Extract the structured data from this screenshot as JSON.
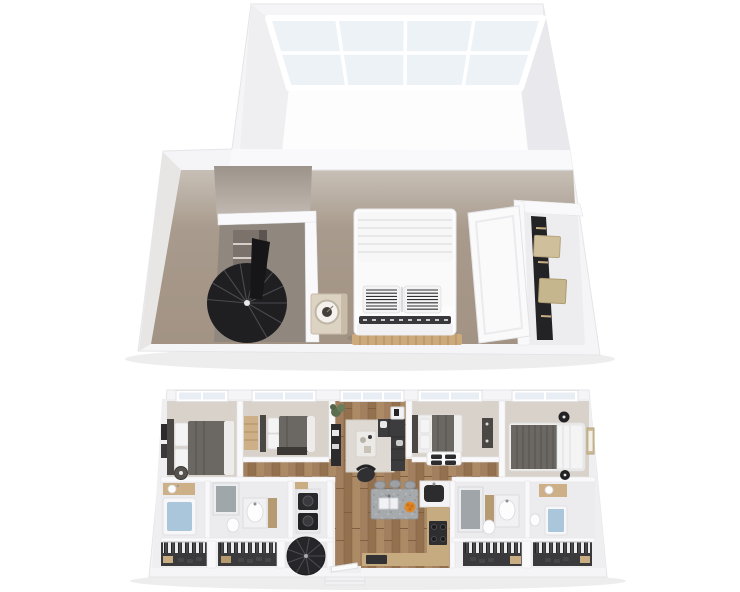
{
  "scene": {
    "type": "3d-floorplan-rendering",
    "levels": [
      {
        "name": "loft-level",
        "elements": [
          "skylight-windows",
          "loft-bedroom",
          "quilted-bed",
          "striped-accent-pillows",
          "nightstand-with-clock",
          "wood-slat-bench",
          "spiral-staircase",
          "closet-shelving",
          "wardrobe-sliding-door",
          "storage-boxes"
        ]
      },
      {
        "name": "main-level",
        "elements": [
          "bedroom-1",
          "bedroom-2",
          "bedroom-3",
          "bedroom-4",
          "living-room",
          "sectional-sofa",
          "coffee-table",
          "tv-console",
          "area-rug",
          "accent-chair",
          "potted-plant",
          "side-table",
          "kitchen-island",
          "bar-stools",
          "fruit-bowl",
          "range-stove",
          "kitchen-counters",
          "bathroom-1",
          "bathroom-2",
          "bathroom-3",
          "bathroom-4",
          "bathtub",
          "shower-stalls",
          "vanity-sinks",
          "toilets",
          "laundry-appliances",
          "closet-1",
          "closet-2",
          "closet-3",
          "closet-4",
          "hanging-clothes",
          "shoes",
          "spiral-staircase",
          "entry-door",
          "windows"
        ]
      }
    ]
  },
  "colors": {
    "wall": "#f5f5f7",
    "wall_inner": "#f9f9fb",
    "wall_edge": "#e5e5e8",
    "wall_face_left": "#efeff2",
    "wall_face_right": "#e9e9ed",
    "glass": "#edf2f7",
    "glass_bright": "#fdfdfe",
    "window_glass": "#e8eef3",
    "loft_floor_light": "#c8c0b7",
    "loft_floor": "#a89a8c",
    "loft_floor_deep": "#a29384",
    "nook_floor": "#90887f",
    "gray_wall_top": "#9c938b",
    "gray_wall_bottom": "#c4bcb4",
    "wood_a": "#a2805f",
    "wood_b": "#93714f",
    "wood_c": "#ad8a66",
    "wood_seam": "#7e5f42",
    "carpet": "#d8d2ca",
    "bath_floor": "#ececee",
    "closet_floor": "#3a3a3d",
    "bed_dark": "#6b6762",
    "bed_stripe": "#5a5651",
    "headboard": "#4a4745",
    "white_fabric": "#f4f4f5",
    "mattress": "#efeeec",
    "pillow_stripe": "#303034",
    "sofa": "#3c3c3f",
    "sofa_line": "#2e2e31",
    "black_furniture": "#232326",
    "dark_gray": "#2c2c2f",
    "stair": "#1f1f22",
    "stair_small": "#26262a",
    "stair_tread": "#4a4a4f",
    "tan": "#c9ae84",
    "tan_light": "#cdb088",
    "tan_deep": "#b6996d",
    "counter_tan": "#c6ab80",
    "water_blue": "#a9c6db",
    "granite_base": "#a6aaad",
    "orange": "#e0882c",
    "orange_deep": "#c97218",
    "plant": "#5c7050",
    "wood_cabinet": "#b59a72",
    "bench_wood": "#cdaa7c",
    "bench_slat": "#b08c5c"
  }
}
